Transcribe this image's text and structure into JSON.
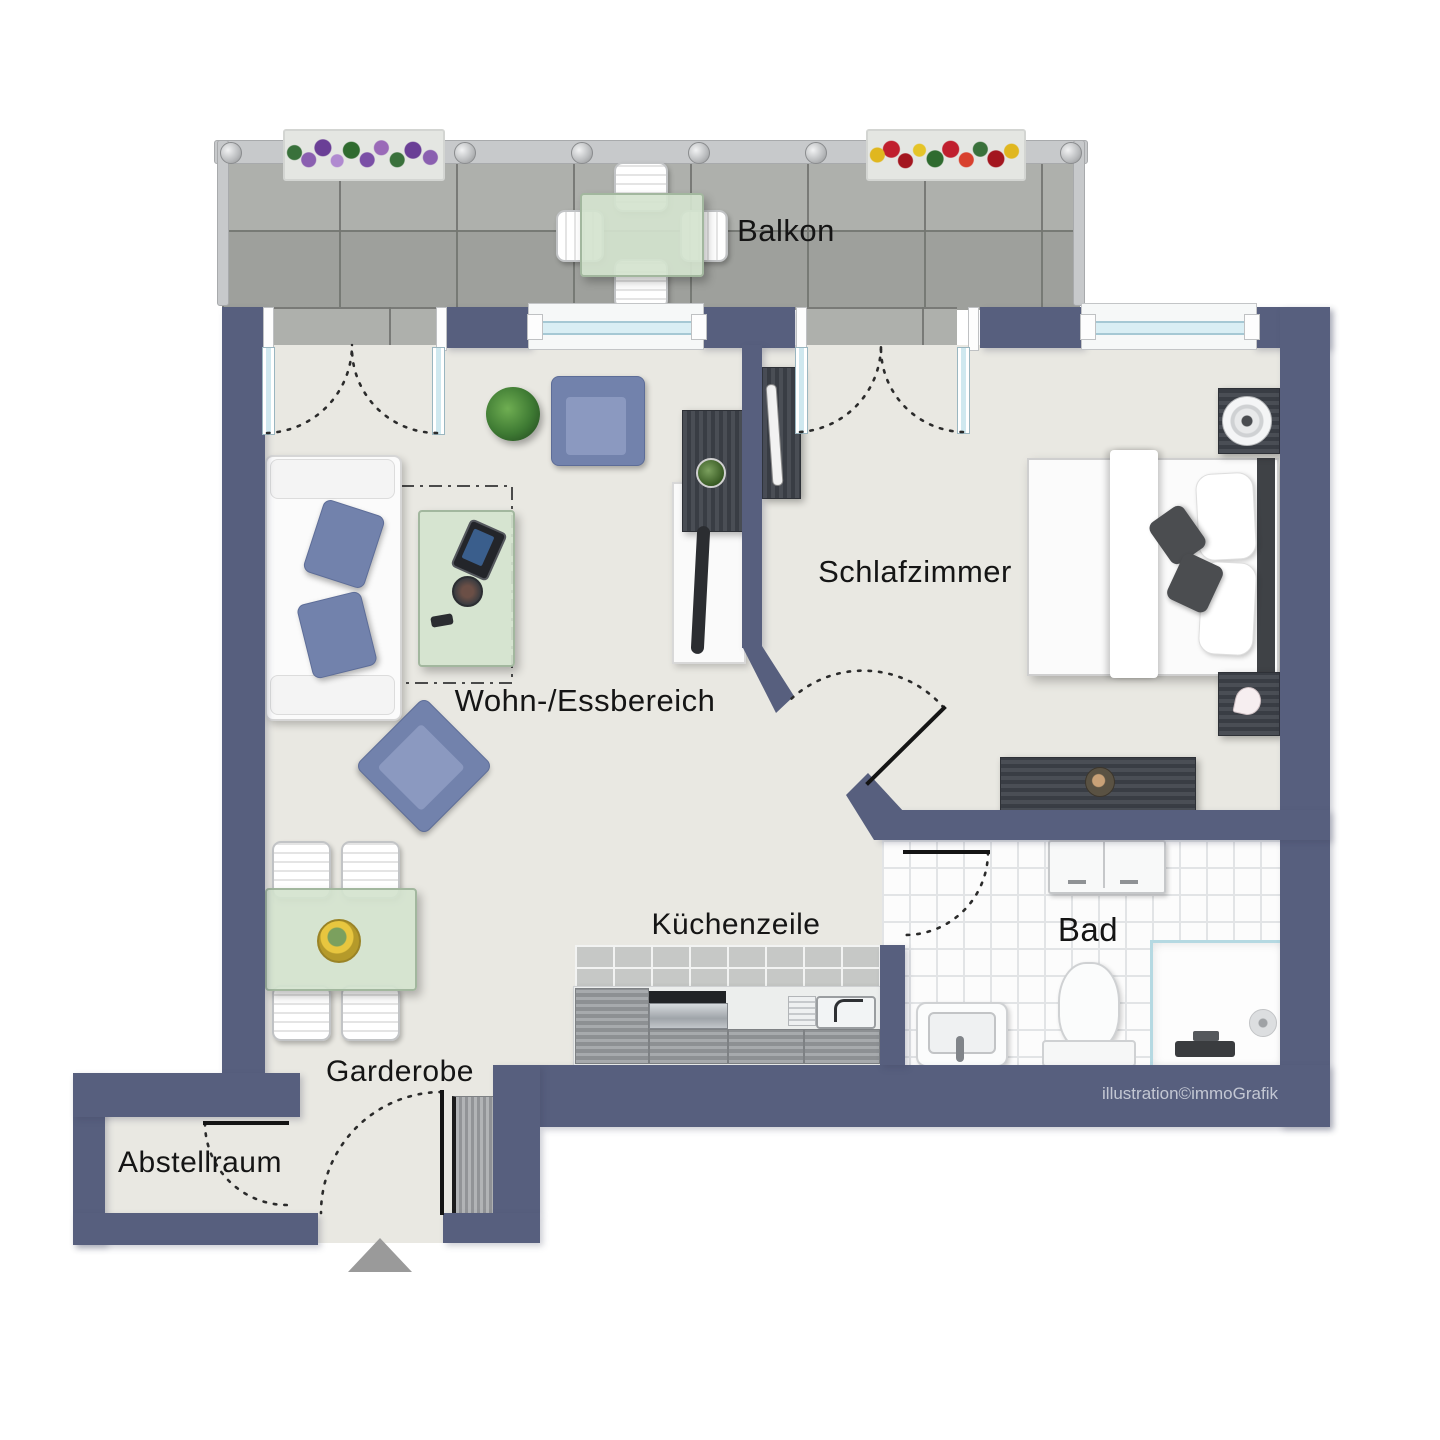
{
  "rooms": {
    "balkon": {
      "label": "Balkon"
    },
    "schlafzimmer": {
      "label": "Schlafzimmer"
    },
    "wohn_essbereich": {
      "label": "Wohn-/Essbereich"
    },
    "kuechenzeile": {
      "label": "Küchenzeile"
    },
    "bad": {
      "label": "Bad"
    },
    "garderobe": {
      "label": "Garderobe"
    },
    "abstellraum": {
      "label": "Abstellraum"
    }
  },
  "watermark": {
    "text": "illustration©immoGrafik",
    "color": "#c3c7d3"
  },
  "colors": {
    "wall": "#575f7e",
    "floor": "#e9e8e2",
    "balcony_tile": "#a8aaa6",
    "bath_tile": "#fcfcfc",
    "upholstery_accent": "#7282ac",
    "glass_table": "#d4e3ce",
    "railing": "#c7c9cb",
    "entrance_arrow": "#9a9a9a",
    "door_swing": "#2b2b2b"
  },
  "entrance": {
    "marker": "arrow-up"
  }
}
